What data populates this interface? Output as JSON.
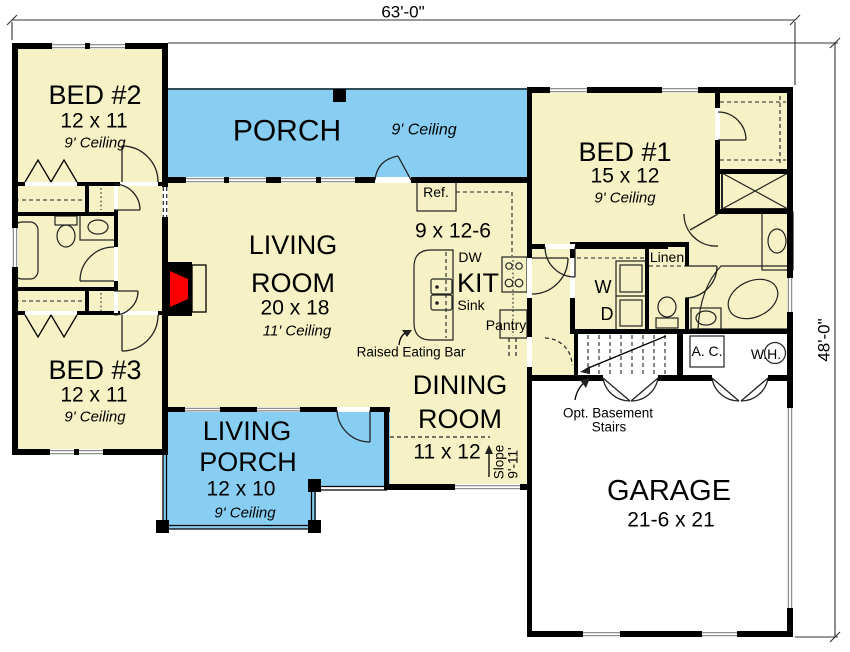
{
  "dimensions": {
    "width": "63'-0\"",
    "depth": "48'-0\""
  },
  "rooms": {
    "bed1": {
      "name": "BED #1",
      "size": "15 x 12",
      "ceiling": "9' Ceiling"
    },
    "bed2": {
      "name": "BED #2",
      "size": "12 x 11",
      "ceiling": "9' Ceiling"
    },
    "bed3": {
      "name": "BED #3",
      "size": "12 x 11",
      "ceiling": "9' Ceiling"
    },
    "porch": {
      "name": "PORCH",
      "ceiling": "9' Ceiling"
    },
    "living": {
      "l1": "LIVING",
      "l2": "ROOM",
      "size": "20 x 18",
      "ceiling": "11' Ceiling"
    },
    "kitchen": {
      "name": "KIT",
      "size": "9 x 12-6"
    },
    "dining": {
      "l1": "DINING",
      "l2": "ROOM",
      "size": "11 x 12"
    },
    "living_porch": {
      "l1": "LIVING",
      "l2": "PORCH",
      "size": "12 x 10",
      "ceiling": "9' Ceiling"
    },
    "garage": {
      "name": "GARAGE",
      "size": "21-6 x 21"
    }
  },
  "labels": {
    "ref": "Ref.",
    "dw": "DW",
    "sink": "Sink",
    "pantry": "Pantry",
    "eating_bar": "Raised Eating Bar",
    "washer": "W",
    "dryer": "D",
    "linen": "Linen",
    "ac": "A. C.",
    "wh": "W.H.",
    "opt_basement_1": "Opt. Basement",
    "opt_basement_2": "Stairs",
    "slope_1": "Slope",
    "slope_2": "9'-11'"
  },
  "colors": {
    "floor": "#F6F2C5",
    "porch": "#87CEF2",
    "fireplace": "#FB0000",
    "wall": "#000000",
    "window": "#8f8f8f"
  }
}
